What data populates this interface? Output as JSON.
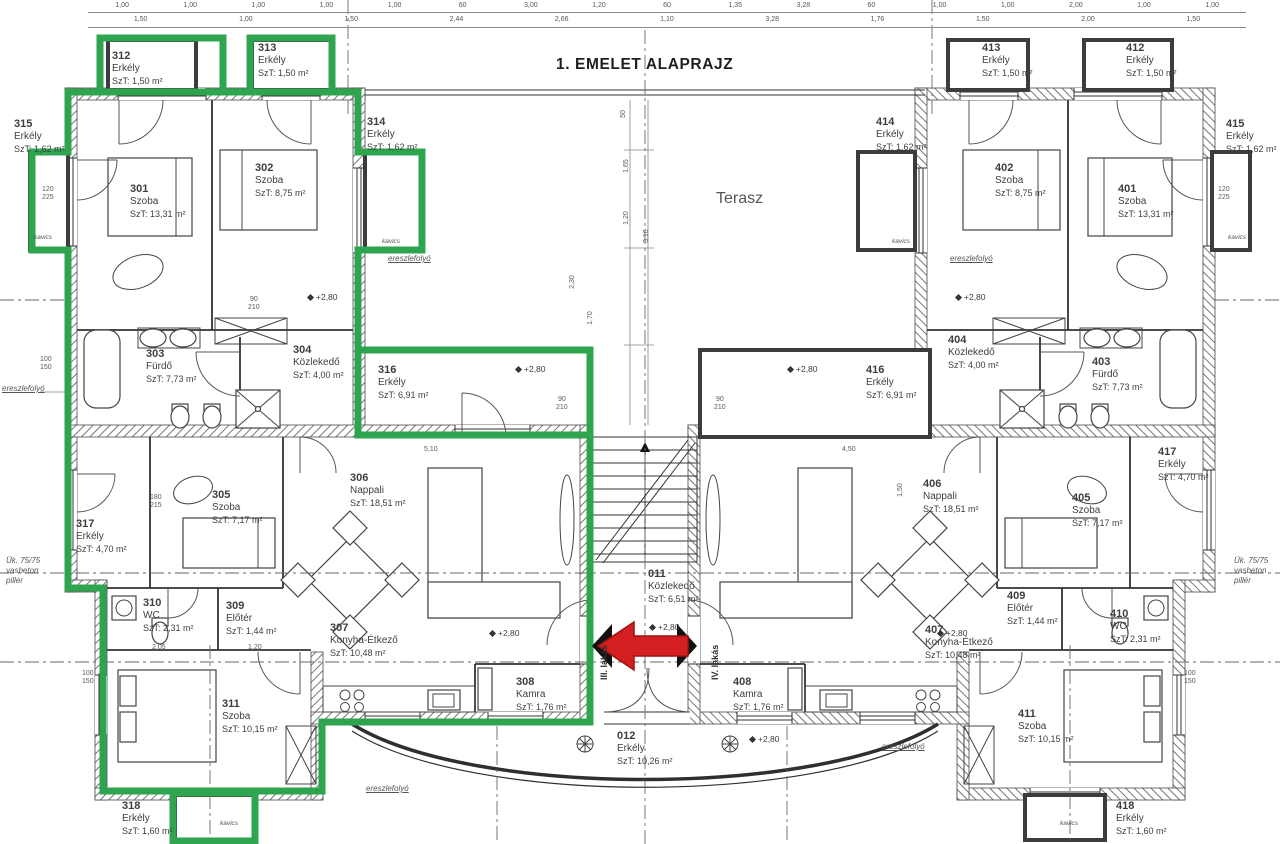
{
  "title": "1. EMELET ALAPRAJZ",
  "terrace_label": "Terasz",
  "elevation_label": "+2,80",
  "units": {
    "left_door_label": "III. lakás",
    "right_door_label": "IV. lakás"
  },
  "colors": {
    "highlight_green": "#2ea44f",
    "arrow_red": "#d31f1f",
    "wall_hatch": "#777777"
  },
  "rooms": [
    {
      "number": "301",
      "name": "Szoba",
      "area": "SzT: 13,31 m²",
      "x": 130,
      "y": 183
    },
    {
      "number": "302",
      "name": "Szoba",
      "area": "SzT: 8,75 m²",
      "x": 255,
      "y": 162
    },
    {
      "number": "303",
      "name": "Fürdő",
      "area": "SzT: 7,73 m²",
      "x": 146,
      "y": 348
    },
    {
      "number": "304",
      "name": "Közlekedő",
      "area": "SzT: 4,00 m²",
      "x": 293,
      "y": 344
    },
    {
      "number": "305",
      "name": "Szoba",
      "area": "SzT: 7,17 m²",
      "x": 212,
      "y": 489
    },
    {
      "number": "306",
      "name": "Nappali",
      "area": "SzT: 18,51 m²",
      "x": 350,
      "y": 472
    },
    {
      "number": "307",
      "name": "Konyha-Étkező",
      "area": "SzT: 10,48 m²",
      "x": 330,
      "y": 622
    },
    {
      "number": "308",
      "name": "Kamra",
      "area": "SzT: 1,76 m²",
      "x": 516,
      "y": 676
    },
    {
      "number": "309",
      "name": "Előtér",
      "area": "SzT: 1,44 m²",
      "x": 226,
      "y": 600
    },
    {
      "number": "310",
      "name": "WC",
      "area": "SzT: 2,31 m²",
      "x": 143,
      "y": 597
    },
    {
      "number": "311",
      "name": "Szoba",
      "area": "SzT: 10,15 m²",
      "x": 222,
      "y": 698
    },
    {
      "number": "312",
      "name": "Erkély",
      "area": "SzT: 1,50 m²",
      "x": 112,
      "y": 50
    },
    {
      "number": "313",
      "name": "Erkély",
      "area": "SzT: 1,50 m²",
      "x": 258,
      "y": 42
    },
    {
      "number": "314",
      "name": "Erkély",
      "area": "SzT: 1,62 m²",
      "x": 367,
      "y": 116
    },
    {
      "number": "315",
      "name": "Erkély",
      "area": "SzT: 1,62 m²",
      "x": 14,
      "y": 118
    },
    {
      "number": "316",
      "name": "Erkély",
      "area": "SzT: 6,91 m²",
      "x": 378,
      "y": 364
    },
    {
      "number": "317",
      "name": "Erkély",
      "area": "SzT: 4,70 m²",
      "x": 76,
      "y": 518
    },
    {
      "number": "318",
      "name": "Erkély",
      "area": "SzT: 1,60 m²",
      "x": 122,
      "y": 800
    },
    {
      "number": "011",
      "name": "Közlekedő",
      "area": "SzT: 6,51 m²",
      "x": 648,
      "y": 568
    },
    {
      "number": "012",
      "name": "Erkély",
      "area": "SzT: 10,26 m²",
      "x": 617,
      "y": 730
    },
    {
      "number": "401",
      "name": "Szoba",
      "area": "SzT: 13,31 m²",
      "x": 1118,
      "y": 183
    },
    {
      "number": "402",
      "name": "Szoba",
      "area": "SzT: 8,75 m²",
      "x": 995,
      "y": 162
    },
    {
      "number": "403",
      "name": "Fürdő",
      "area": "SzT: 7,73 m²",
      "x": 1092,
      "y": 356
    },
    {
      "number": "404",
      "name": "Közlekedő",
      "area": "SzT: 4,00 m²",
      "x": 948,
      "y": 334
    },
    {
      "number": "405",
      "name": "Szoba",
      "area": "SzT: 7,17 m²",
      "x": 1072,
      "y": 492
    },
    {
      "number": "406",
      "name": "Nappali",
      "area": "SzT: 18,51 m²",
      "x": 923,
      "y": 478
    },
    {
      "number": "407",
      "name": "Konyha-Étkező",
      "area": "SzT: 10,48 m²",
      "x": 925,
      "y": 624
    },
    {
      "number": "408",
      "name": "Kamra",
      "area": "SzT: 1,76 m²",
      "x": 733,
      "y": 676
    },
    {
      "number": "409",
      "name": "Előtér",
      "area": "SzT: 1,44 m²",
      "x": 1007,
      "y": 590
    },
    {
      "number": "410",
      "name": "WC",
      "area": "SzT: 2,31 m²",
      "x": 1110,
      "y": 608
    },
    {
      "number": "411",
      "name": "Szoba",
      "area": "SzT: 10,15 m²",
      "x": 1018,
      "y": 708
    },
    {
      "number": "412",
      "name": "Erkély",
      "area": "SzT: 1,50 m²",
      "x": 1126,
      "y": 42
    },
    {
      "number": "413",
      "name": "Erkély",
      "area": "SzT: 1,50 m²",
      "x": 982,
      "y": 42
    },
    {
      "number": "414",
      "name": "Erkély",
      "area": "SzT: 1,62 m²",
      "x": 876,
      "y": 116
    },
    {
      "number": "415",
      "name": "Erkély",
      "area": "SzT: 1,62 m²",
      "x": 1226,
      "y": 118
    },
    {
      "number": "416",
      "name": "Erkély",
      "area": "SzT: 6,91 m²",
      "x": 866,
      "y": 364
    },
    {
      "number": "417",
      "name": "Erkély",
      "area": "SzT: 4,70 m²",
      "x": 1158,
      "y": 446
    },
    {
      "number": "418",
      "name": "Erkély",
      "area": "SzT: 1,60 m²",
      "x": 1116,
      "y": 800
    }
  ],
  "dim_row1": [
    "1,00",
    "1,00",
    "1,00",
    "1,00",
    "1,00",
    "60",
    "3,00",
    "1,20",
    "60",
    "1,35",
    "3,28",
    "60",
    "1,00",
    "1,00",
    "2,00",
    "1,00",
    "1,00"
  ],
  "dim_row2": [
    "1,50",
    "1,00",
    "1,50",
    "2,44",
    "2,66",
    "1,10",
    "3,28",
    "1,76",
    "1,50",
    "2,00",
    "1,50"
  ],
  "dim_marks": [
    {
      "t": "90\n210",
      "x": 556,
      "y": 396,
      "r": 0
    },
    {
      "t": "90\n210",
      "x": 714,
      "y": 396,
      "r": 0
    },
    {
      "t": "120\n225",
      "x": 42,
      "y": 186,
      "r": 0
    },
    {
      "t": "120\n225",
      "x": 1218,
      "y": 186,
      "r": 0
    },
    {
      "t": "100\n150",
      "x": 40,
      "y": 356,
      "r": 0
    },
    {
      "t": "100\n150",
      "x": 82,
      "y": 670,
      "r": 0
    },
    {
      "t": "100\n150",
      "x": 1184,
      "y": 670,
      "r": 0
    },
    {
      "t": "180\n215",
      "x": 150,
      "y": 494,
      "r": 0
    },
    {
      "t": "90\n210",
      "x": 248,
      "y": 296,
      "r": 0
    },
    {
      "t": "50",
      "x": 620,
      "y": 110,
      "r": -90
    },
    {
      "t": "1,65",
      "x": 620,
      "y": 162,
      "r": -90
    },
    {
      "t": "1,20",
      "x": 620,
      "y": 214,
      "r": -90
    },
    {
      "t": "3,10",
      "x": 640,
      "y": 232,
      "r": -90
    },
    {
      "t": "2,30",
      "x": 566,
      "y": 278,
      "r": -90
    },
    {
      "t": "1,70",
      "x": 584,
      "y": 314,
      "r": -90
    },
    {
      "t": "5,10",
      "x": 424,
      "y": 446,
      "r": 0
    },
    {
      "t": "4,50",
      "x": 842,
      "y": 446,
      "r": 0
    },
    {
      "t": "2,05",
      "x": 152,
      "y": 644,
      "r": 0
    },
    {
      "t": "1,20",
      "x": 248,
      "y": 644,
      "r": 0
    },
    {
      "t": "1,50",
      "x": 894,
      "y": 486,
      "r": -90
    }
  ],
  "elevations": [
    {
      "x": 308,
      "y": 292
    },
    {
      "x": 956,
      "y": 292
    },
    {
      "x": 516,
      "y": 364
    },
    {
      "x": 788,
      "y": 364
    },
    {
      "x": 650,
      "y": 622
    },
    {
      "x": 750,
      "y": 734
    },
    {
      "x": 490,
      "y": 628
    },
    {
      "x": 938,
      "y": 628
    }
  ],
  "annotations": [
    {
      "t": "ereszlefolyó",
      "x": 388,
      "y": 254,
      "u": true
    },
    {
      "t": "ereszlefolyó",
      "x": 950,
      "y": 254,
      "u": true
    },
    {
      "t": "ereszlefolyó",
      "x": 366,
      "y": 784,
      "u": true
    },
    {
      "t": "ereszlefolyó",
      "x": 882,
      "y": 742,
      "u": true
    },
    {
      "t": "ereszlefolyó",
      "x": 2,
      "y": 384,
      "u": true
    },
    {
      "t": "Ük. 75/75\nvasbeton\npillér",
      "x": 6,
      "y": 556,
      "u": false
    },
    {
      "t": "Ük. 75/75\nvasbeton\npillér",
      "x": 1234,
      "y": 556,
      "u": false
    },
    {
      "t": "kavics",
      "x": 382,
      "y": 238,
      "u": false,
      "tiny": true
    },
    {
      "t": "kavics",
      "x": 220,
      "y": 820,
      "u": false,
      "tiny": true
    },
    {
      "t": "kavics",
      "x": 892,
      "y": 238,
      "u": false,
      "tiny": true
    },
    {
      "t": "kavics",
      "x": 1060,
      "y": 820,
      "u": false,
      "tiny": true
    },
    {
      "t": "kavics",
      "x": 34,
      "y": 234,
      "u": false,
      "tiny": true
    },
    {
      "t": "kavics",
      "x": 1228,
      "y": 234,
      "u": false,
      "tiny": true
    }
  ]
}
